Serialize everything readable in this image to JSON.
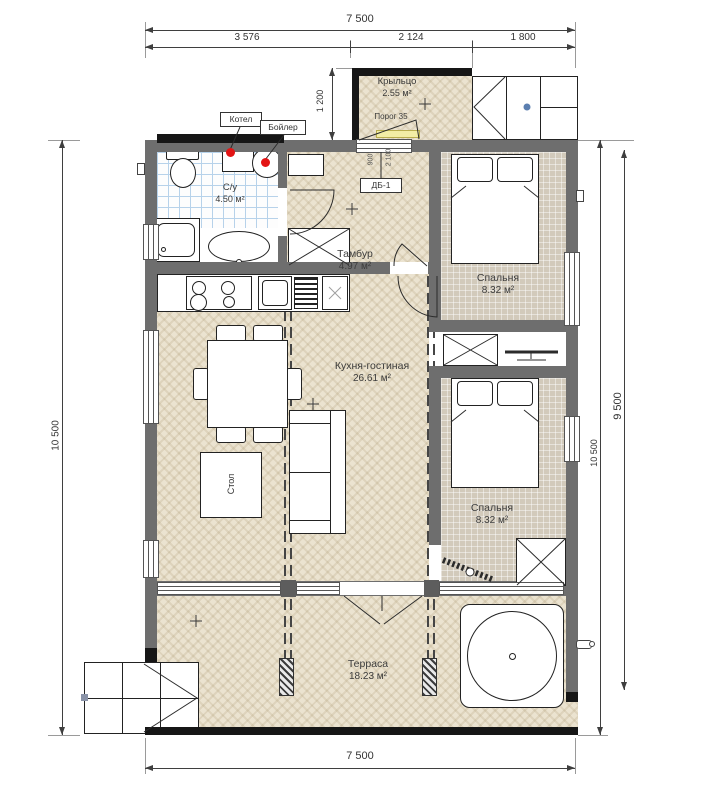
{
  "dims": {
    "top_total": "7 500",
    "top_segments": [
      "3 576",
      "2 124",
      "1 800"
    ],
    "bottom_total": "7 500",
    "left_total": "10 500",
    "right_inner": "10 500",
    "right_outer": "9 500",
    "porch_depth": "1 200",
    "door_width": "900",
    "door_height": "2 100"
  },
  "rooms": {
    "porch": {
      "name": "Крыльцо",
      "area": "2.55 м²"
    },
    "bathroom": {
      "name": "С/у",
      "area": "4.50 м²"
    },
    "vestibule": {
      "name": "Тамбур",
      "area": "4.97 м²"
    },
    "bedroom_top": {
      "name": "Спальня",
      "area": "8.32 м²"
    },
    "kitchen_living": {
      "name": "Кухня-гостиная",
      "area": "26.61 м²"
    },
    "bedroom_bottom": {
      "name": "Спальня",
      "area": "8.32 м²"
    },
    "terrace": {
      "name": "Терраса",
      "area": "18.23 м²"
    }
  },
  "annotations": {
    "boiler": "Котел",
    "water_heater": "Бойлер",
    "threshold": "Порог 35",
    "table": "Стол",
    "door_tag": "ДБ-1"
  },
  "colors": {
    "wall": "#6e6e6e",
    "black_wall": "#161616",
    "accent_red": "#e31414",
    "threshold_yellow": "#f3eda5",
    "tile_blue": "#b7d2ea",
    "floor_cream": "#ebe3d0",
    "carpet_beige": "#d2cabb",
    "marker_blue": "#5b7fb0"
  }
}
